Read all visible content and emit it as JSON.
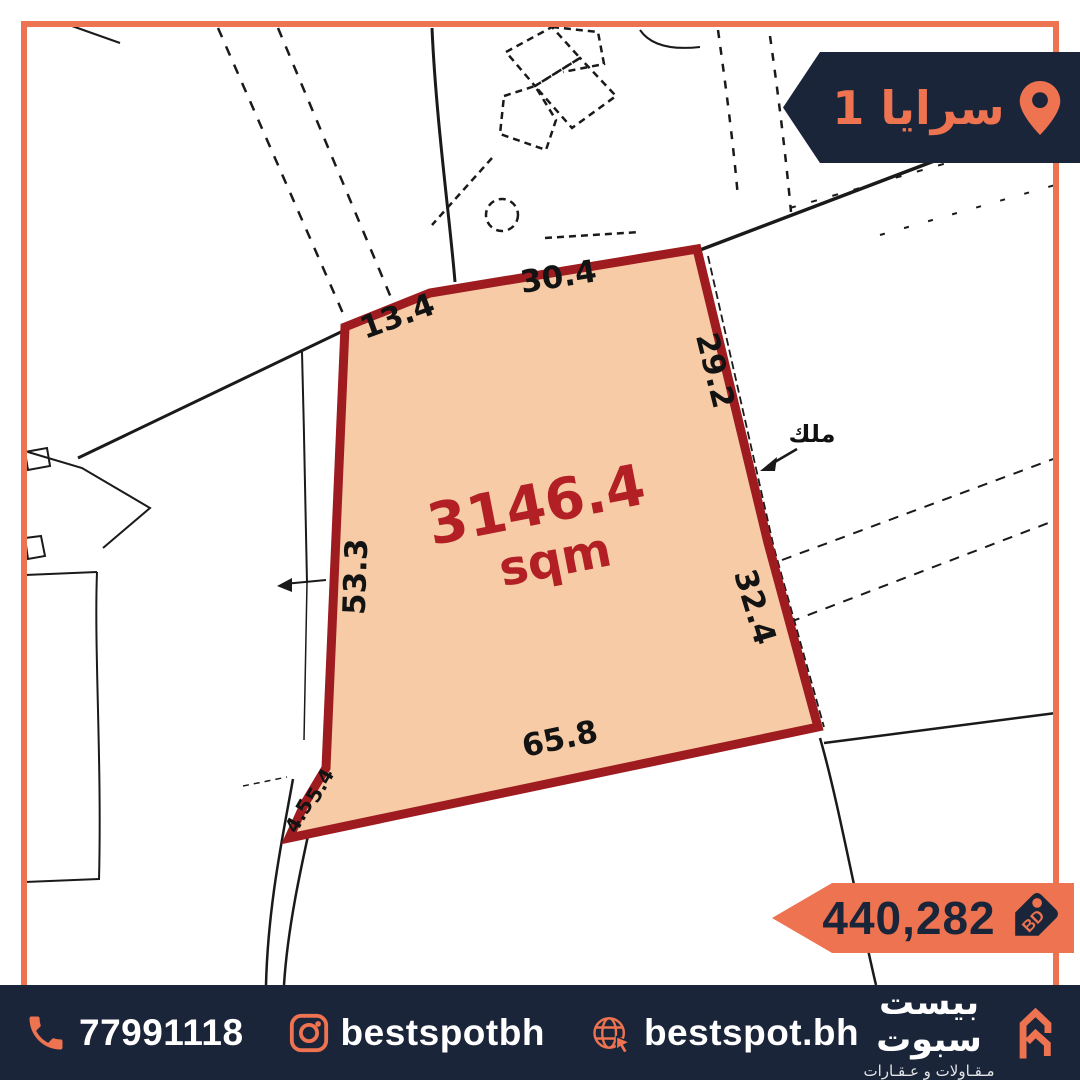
{
  "palette": {
    "accent_orange": "#ee7350",
    "navy": "#1b2539",
    "parcel_fill": "#f6cba6",
    "parcel_border": "#9e1b20",
    "area_text": "#b21f24",
    "map_line": "#1a1a1a"
  },
  "location_banner": {
    "label": "سرايا 1",
    "icon": "location-pin-icon"
  },
  "map": {
    "area_value": "3146.4",
    "area_unit": "sqm",
    "owner_label": "ملك",
    "measurements": {
      "top_left": "13.4",
      "top": "30.4",
      "right_upper": "29.2",
      "left": "53.3",
      "right_lower": "32.4",
      "bottom": "65.8",
      "corner_small_1": "4.5",
      "corner_small_2": "5.4"
    }
  },
  "price_banner": {
    "amount": "440,282",
    "currency": "BD",
    "icon": "price-tag-icon"
  },
  "footer": {
    "phone": {
      "icon": "phone-icon",
      "value": "77991118"
    },
    "instagram": {
      "icon": "instagram-icon",
      "value": "bestspotbh"
    },
    "website": {
      "icon": "globe-icon",
      "value": "bestspot.bh"
    },
    "brand": {
      "name": "بيست سبوت",
      "tagline": "مـقـاولات و عـقـارات",
      "logo": "double-chevron-logo"
    }
  }
}
